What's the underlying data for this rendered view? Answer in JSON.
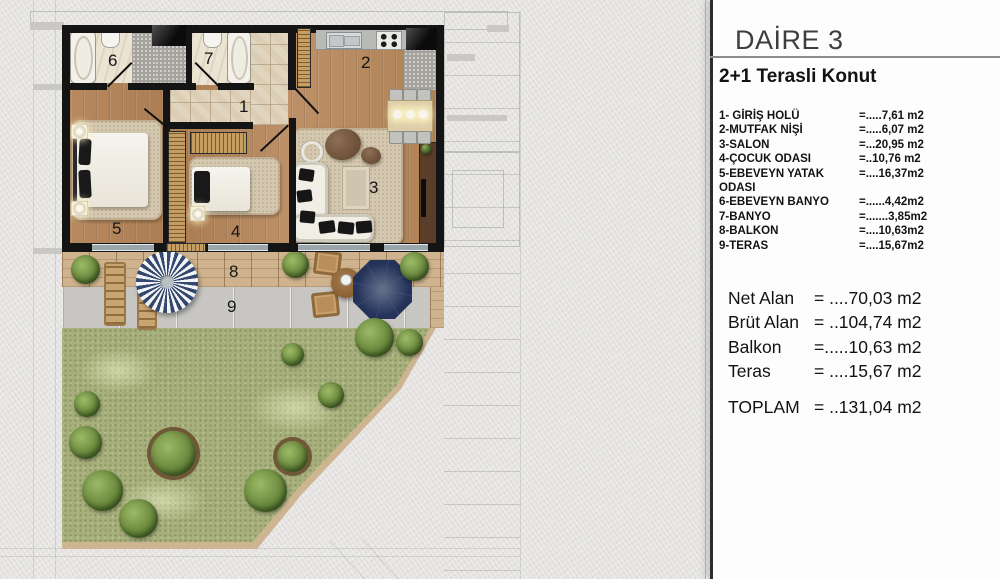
{
  "panel": {
    "title": "DAİRE 3",
    "subtitle": "2+1  Terasli Konut",
    "rooms": [
      {
        "label": "1- GİRİŞ HOLÜ",
        "value": "=.....7,61 m2"
      },
      {
        "label": "2-MUTFAK NİŞİ",
        "value": "=.....6,07 m2"
      },
      {
        "label": "3-SALON",
        "value": "=...20,95 m2"
      },
      {
        "label": "4-ÇOCUK ODASI",
        "value": "=..10,76 m2"
      },
      {
        "label": "5-EBEVEYN YATAK ODASI",
        "value": "=....16,37m2"
      },
      {
        "label": "6-EBEVEYN BANYO",
        "value": "=......4,42m2"
      },
      {
        "label": "7-BANYO",
        "value": "=.......3,85m2"
      },
      {
        "label": "8-BALKON",
        "value": "=....10,63m2"
      },
      {
        "label": "9-TERAS",
        "value": "=....15,67m2"
      }
    ],
    "summary": [
      {
        "label": "Net Alan",
        "value": "= ....70,03 m2"
      },
      {
        "label": "Brüt Alan",
        "value": "= ..104,74 m2"
      },
      {
        "label": "Balkon",
        "value": "=.....10,63 m2"
      },
      {
        "label": "Teras",
        "value": "= ....15,67 m2"
      }
    ],
    "total": {
      "label": "TOPLAM",
      "value": "= ..131,04 m2"
    }
  },
  "plan": {
    "numbers": {
      "hall": "1",
      "kitchen": "2",
      "salon": "3",
      "cocuk": "4",
      "yatak": "5",
      "ebanyo": "6",
      "banyo": "7",
      "balkon": "8",
      "teras": "9"
    }
  },
  "colors": {
    "parasol_navy": "#2e3f6d",
    "grass": "#a7b07c",
    "wood_floor": "#b4885e",
    "panel_bg": "#fdfdfd",
    "title_gray": "#3e3e3e",
    "wall_black": "#141414"
  }
}
